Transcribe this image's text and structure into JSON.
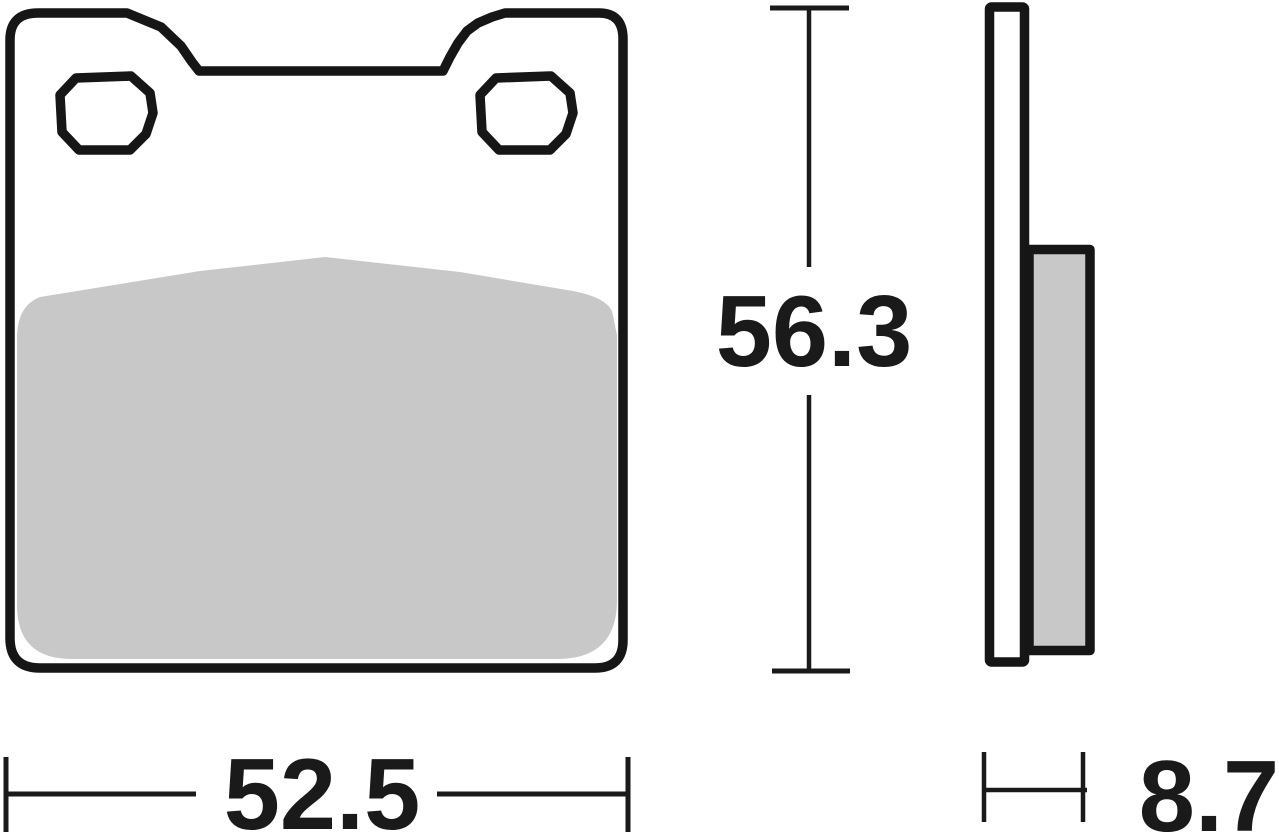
{
  "drawing": {
    "dimensions": {
      "width": "52.5",
      "height": "56.3",
      "thickness": "8.7"
    },
    "colors": {
      "outline": "#161616",
      "friction": "#c8c8c8",
      "dimension": "#1a1a1a",
      "background": "#ffffff"
    }
  }
}
